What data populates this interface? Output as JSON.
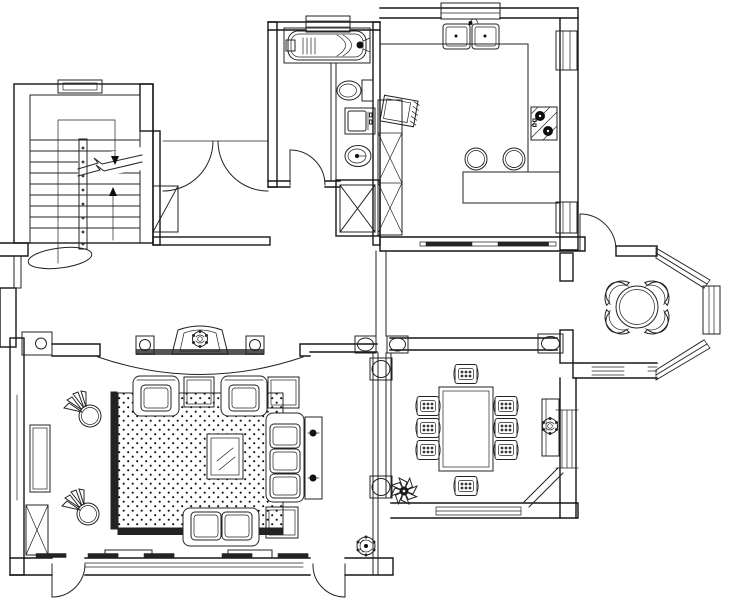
{
  "meta": {
    "type": "architectural-floor-plan",
    "style": "black-and-white CAD line drawing, top view, no text labels",
    "visible_text": []
  },
  "canvas": {
    "width": 740,
    "height": 600,
    "background": "#ffffff",
    "line_color": "#232323",
    "wall_color": "#161616",
    "dark_fill": "#0e0e0e"
  },
  "rooms": [
    {
      "name": "staircase-hall",
      "position": "top-left",
      "features": [
        "u-shaped-stair",
        "handrail",
        "break-line",
        "up-down-arrows",
        "double-door-swing",
        "shaft-box"
      ]
    },
    {
      "name": "bathroom",
      "position": "top-middle",
      "features": [
        "bathtub",
        "toilet",
        "washing-machine",
        "washbasin",
        "x-closet",
        "door-swing",
        "window"
      ]
    },
    {
      "name": "kitchen",
      "position": "top-right",
      "features": [
        "double-sink",
        "counter",
        "cooktop",
        "tall-cabinet",
        "microwave",
        "island-bar",
        "bar-stools",
        "windows"
      ]
    },
    {
      "name": "breakfast-nook",
      "position": "middle-right",
      "features": [
        "octagonal-bay-windows",
        "round-table",
        "curved-chairs",
        "door-swing"
      ]
    },
    {
      "name": "living-room",
      "position": "bottom-left",
      "features": [
        "tv-console",
        "speakers",
        "arch-arc",
        "dotted-rug",
        "coffee-table",
        "sofa-set",
        "plants",
        "cabinets",
        "french-doors",
        "windows"
      ]
    },
    {
      "name": "dining-room",
      "position": "bottom-middle",
      "features": [
        "dining-table",
        "chairs",
        "columned-screen",
        "beam-with-columns",
        "sideboard",
        "plants",
        "chamfered-corner",
        "windows"
      ]
    },
    {
      "name": "entrance-lobby",
      "position": "bottom-middle",
      "features": [
        "entry-door-swing",
        "potted-plant",
        "column"
      ]
    }
  ],
  "furniture_counts": {
    "dining_chairs": 8,
    "nook_chairs": 4,
    "bar_stools": 2,
    "armchairs": 2,
    "three_seat_sofa": 1,
    "loveseat": 1,
    "side_tables": 4,
    "fan_plants": 2,
    "dark_plant": 1,
    "potted_plant": 1,
    "speakers": 2,
    "tv": 1
  }
}
